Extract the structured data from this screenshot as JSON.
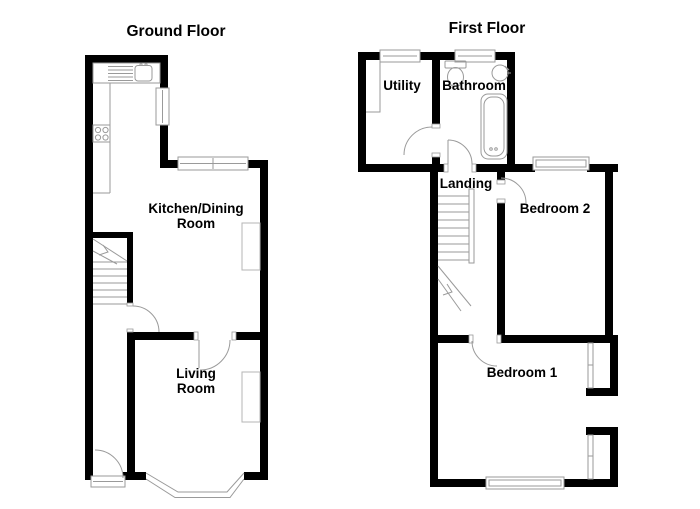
{
  "colors": {
    "wall": "#000000",
    "fixture": "#9a9a9a",
    "chimney": "#b5b5b5",
    "text": "#000000"
  },
  "ground_floor": {
    "title": "Ground Floor",
    "rooms": {
      "kitchen_line1": "Kitchen/Dining",
      "kitchen_line2": "Room",
      "living_line1": "Living",
      "living_line2": "Room"
    }
  },
  "first_floor": {
    "title": "First Floor",
    "rooms": {
      "utility": "Utility",
      "bathroom": "Bathroom",
      "landing": "Landing",
      "bedroom2": "Bedroom 2",
      "bedroom1": "Bedroom 1"
    }
  }
}
